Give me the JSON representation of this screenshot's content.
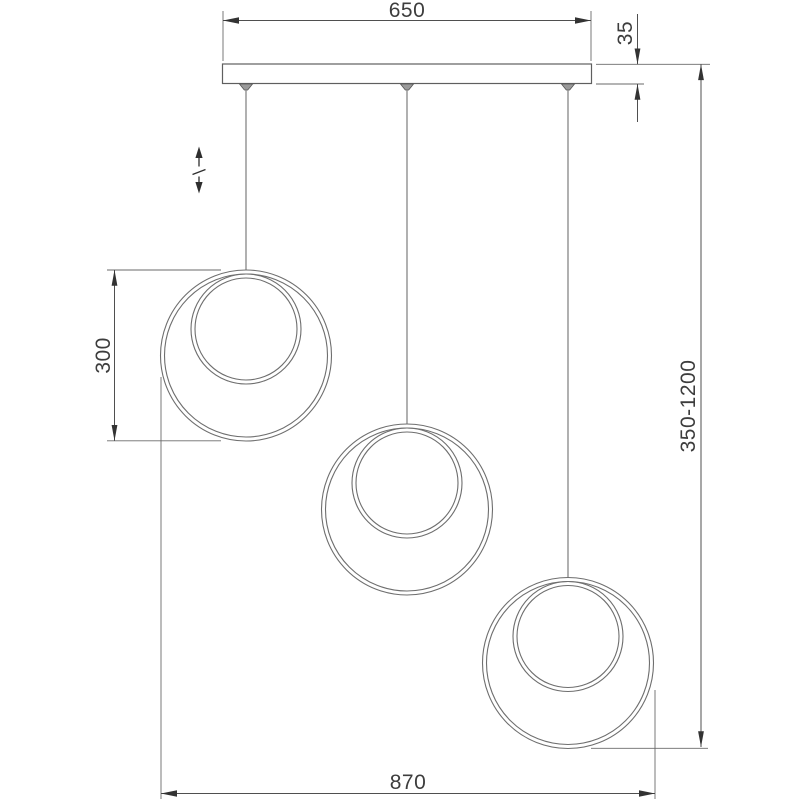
{
  "drawing": {
    "kind": "pendant-ceiling-light-dimension-drawing",
    "background": "#ffffff",
    "line_color": "#6e6e6e",
    "dimension_line_color": "#4f4f4f",
    "text_color": "#3d3d3d"
  },
  "dimensions": {
    "canopy_width": "650",
    "canopy_thickness": "35",
    "ring_diameter": "300",
    "suspension_height_range": "350-1200",
    "overall_width": "870"
  },
  "icons": {
    "adjustable_height": "adjustable-height-double-arrow"
  }
}
